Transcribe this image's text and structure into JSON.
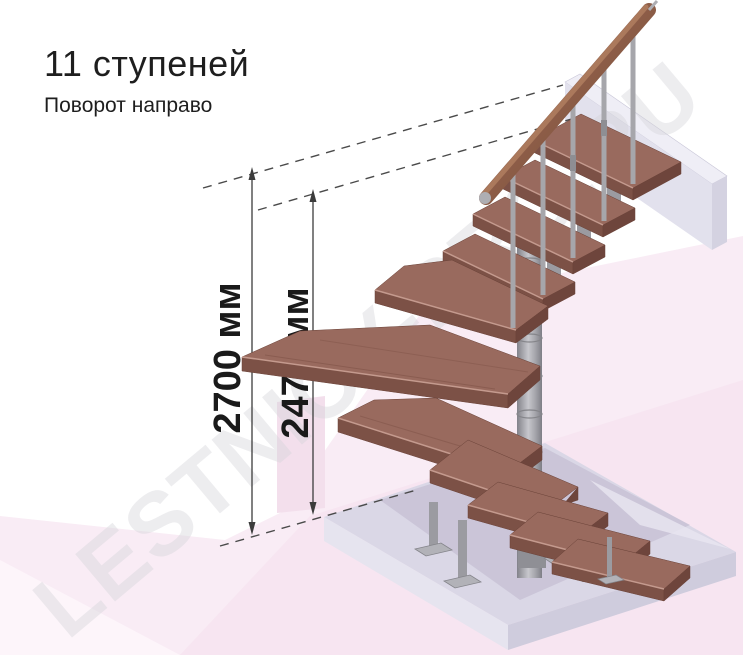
{
  "header": {
    "title": "11 ступеней",
    "subtitle": "Поворот направо"
  },
  "dimension_annotations": [
    {
      "id": "total-height",
      "label": "2700 мм"
    },
    {
      "id": "height-to-landing",
      "label": "2475 мм"
    }
  ],
  "watermark": {
    "text": "LESTNICY-PRO.RU"
  },
  "scene": {
    "steps_count": 11,
    "colors": {
      "background": "#ffffff",
      "backdrop_pink": "#f9ecf5",
      "backdrop_pink_dark": "#f3dfec",
      "floor_slab": "#dad7e6",
      "upper_slab": "#e2e1ed",
      "step_wood_top": "#996a5e",
      "step_wood_front": "#7c5146",
      "metal": "#a6a6ab",
      "handrail_wood": "#7d4e3c",
      "dimension_line": "#3c3c3c"
    }
  }
}
